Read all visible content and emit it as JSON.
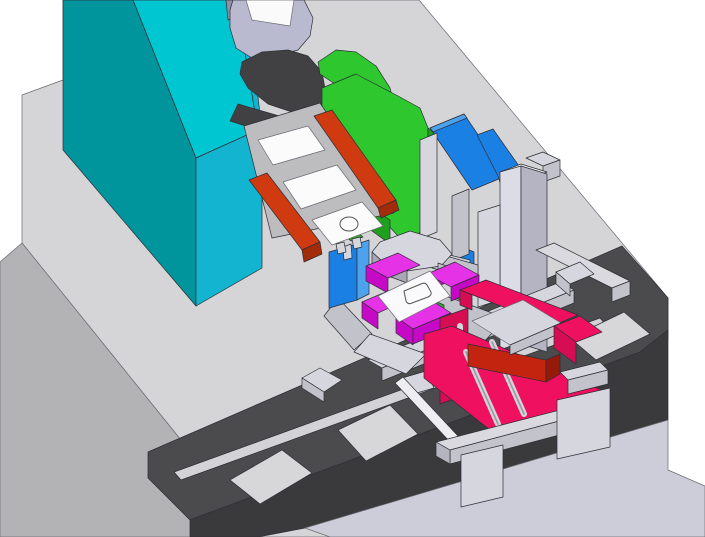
{
  "meta": {
    "view": "isometric-3d-cad-assembly-render",
    "description_labels": {
      "machine_column": "machine column",
      "label_roll": "material roll",
      "dark_roller": "drive roller",
      "green_chute": "green chute plate",
      "feeder_tray": "feeder tray with sheets",
      "pickup_plate": "vacuum pickup plate",
      "gripper_stage": "magenta gripper stage",
      "transfer_slide": "crimson transfer slide",
      "conveyor": "conveyor track with pallets"
    }
  },
  "palette": {
    "white_bg": "#ffffff",
    "table_top": "#d5d5d7",
    "table_side": "#b3b3b5",
    "foreground_plane": "#cdcdd9",
    "conveyor_top": "#4b4b4d",
    "conveyor_front": "#3a3a3c",
    "pallet": "#d7d7d9",
    "teal_front": "#00949c",
    "teal_top": "#00c6d2",
    "teal_right": "#12b4cf",
    "roll_body": "#b9b9cf",
    "roll_shadow": "#8f8fa5",
    "roll_label": "#fafafa",
    "roller_dark": "#414143",
    "green": "#2ec82e",
    "green_dark": "#1ea01e",
    "green_strip": "#2aae2a",
    "red_rail": "#cf3a10",
    "red_rail_dark": "#a22c0a",
    "tray_gray": "#bdbdbf",
    "sheet_white": "#fbfbfb",
    "blue": "#1b80e4",
    "blue_top": "#4ca2ec",
    "gray_light": "#d6d6de",
    "gray_mid": "#c2c2ca",
    "gray_shadow": "#a8a8b4",
    "pillar_front": "#dcdce6",
    "pillar_right": "#b4b4c2",
    "pillar_top": "#ebebf2",
    "magenta_top": "#e632e6",
    "magenta_front": "#c609c6",
    "stage_white": "#fafafc",
    "crimson": "#ef1160",
    "crimson_front": "#d60d52",
    "red_block": "#c32410",
    "red_block_dark": "#951a0a",
    "rod_white": "#eeeef2",
    "rail_light": "#d3d3d7",
    "bracket_light": "#d9d9df",
    "bracket_mid": "#c3c3cb",
    "bracket_dark": "#b4b4be"
  }
}
